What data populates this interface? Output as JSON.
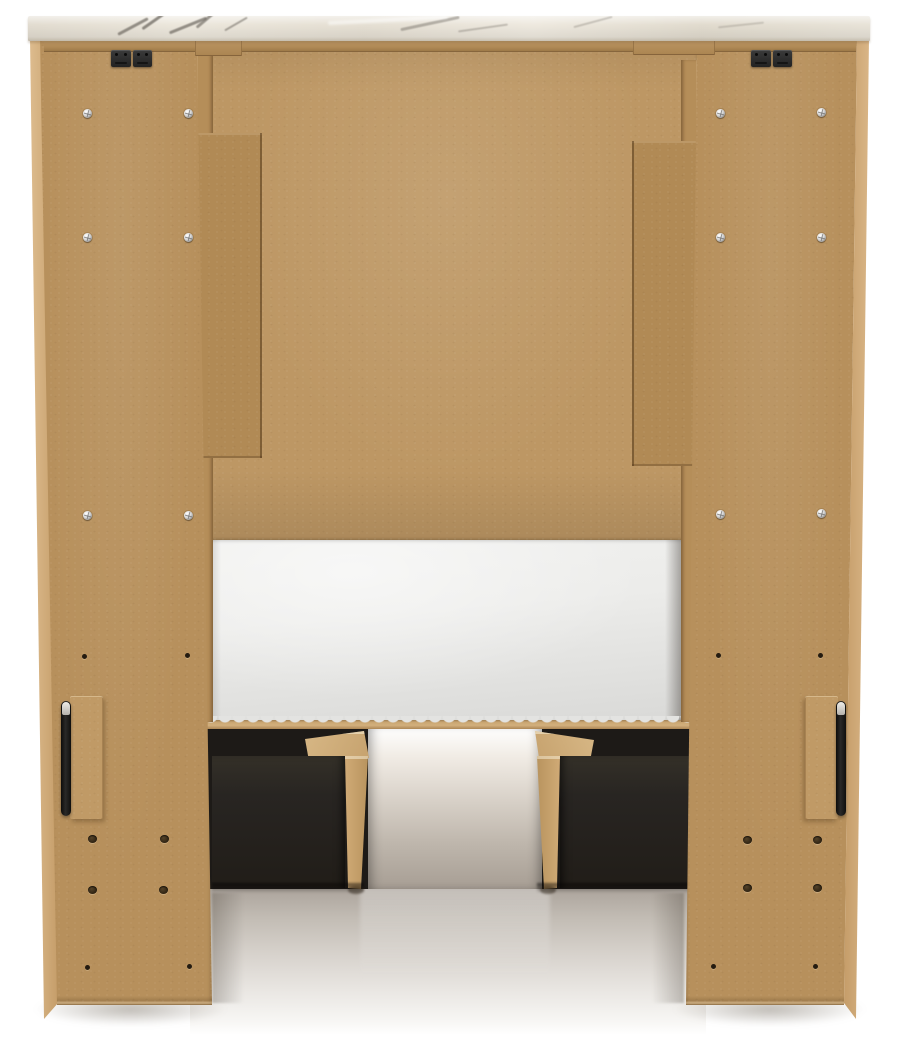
{
  "scene": {
    "title": "Back view of a bed frame with under-bed storage drawers",
    "background": "#ffffff"
  },
  "parts": {
    "top_cap": "marble-look top cap",
    "left_pier": "left pier back panel",
    "right_pier": "right pier back panel",
    "headboard": "headboard back panel",
    "left_cleat": "left vertical cleat",
    "right_cleat": "right vertical cleat",
    "mattress": "mattress",
    "bed_rail": "bed side rail",
    "left_drawer": "left under-bed storage drawer",
    "right_drawer": "right under-bed storage drawer",
    "left_handle": "left side handle",
    "right_handle": "right side handle",
    "left_bracket": "left mounting bracket",
    "right_bracket": "right mounting bracket"
  },
  "colors": {
    "panel_tan": "#b7905c",
    "panel_tan_light": "#bd9764",
    "panel_edge_light": "#c49c68",
    "cleat_tan": "#b18a55",
    "marble_base": "#e7e1d6",
    "marble_vein": "#6f6a62",
    "mattress_white": "#ececea",
    "drawer_black": "#282522",
    "underbed_dark": "#1d1a17",
    "glide_tan": "#c6a26e",
    "hardware_black": "#2d2b29",
    "handle_black": "#2a2928",
    "handle_highlight": "#b5b2ac",
    "hole_dark": "#2e2212",
    "floor_gray": "#b3aba2"
  },
  "hardware": {
    "screws": [
      {
        "x": 83,
        "y": 109
      },
      {
        "x": 184,
        "y": 109
      },
      {
        "x": 83,
        "y": 233
      },
      {
        "x": 184,
        "y": 233
      },
      {
        "x": 83,
        "y": 511
      },
      {
        "x": 184,
        "y": 511
      },
      {
        "x": 716,
        "y": 109
      },
      {
        "x": 817,
        "y": 108
      },
      {
        "x": 716,
        "y": 233
      },
      {
        "x": 817,
        "y": 233
      },
      {
        "x": 716,
        "y": 510
      },
      {
        "x": 817,
        "y": 509
      }
    ],
    "holes_large": [
      {
        "x": 88,
        "y": 835
      },
      {
        "x": 160,
        "y": 835
      },
      {
        "x": 88,
        "y": 886
      },
      {
        "x": 159,
        "y": 886
      },
      {
        "x": 743,
        "y": 836
      },
      {
        "x": 813,
        "y": 836
      },
      {
        "x": 743,
        "y": 884
      },
      {
        "x": 813,
        "y": 884
      }
    ],
    "holes_small": [
      {
        "x": 82,
        "y": 654
      },
      {
        "x": 185,
        "y": 653
      },
      {
        "x": 716,
        "y": 653
      },
      {
        "x": 818,
        "y": 653
      },
      {
        "x": 85,
        "y": 965
      },
      {
        "x": 187,
        "y": 964
      },
      {
        "x": 711,
        "y": 964
      },
      {
        "x": 813,
        "y": 964
      }
    ],
    "brackets": [
      {
        "x": 111,
        "y": 50
      },
      {
        "x": 751,
        "y": 50
      }
    ]
  }
}
